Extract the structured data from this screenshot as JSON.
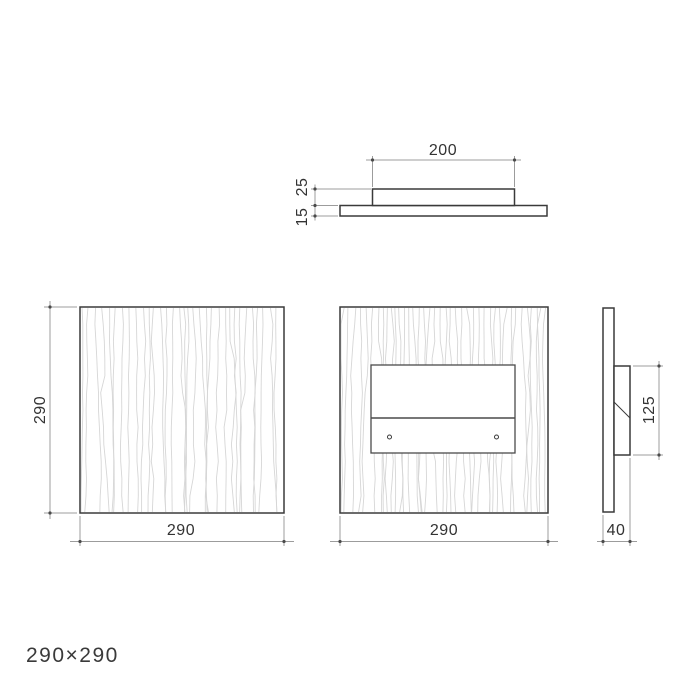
{
  "drawing": {
    "product_size_label": "290×290",
    "views": {
      "top_section": {
        "dim_width": "200",
        "dim_bracket_thickness": "25",
        "dim_panel_thickness": "15"
      },
      "front": {
        "dim_height": "290",
        "dim_width": "290"
      },
      "back": {
        "dim_width": "290"
      },
      "side": {
        "dim_bracket_height": "125",
        "dim_depth": "40"
      }
    }
  },
  "colors": {
    "background": "#ffffff",
    "outline": "#3a3a3a",
    "dimension_line": "#9c9c9c",
    "dimension_dot": "#4a4a4a",
    "dimension_text": "#333333",
    "wood_grain": "#d6d6d6",
    "label_text": "#3a3a3a"
  }
}
